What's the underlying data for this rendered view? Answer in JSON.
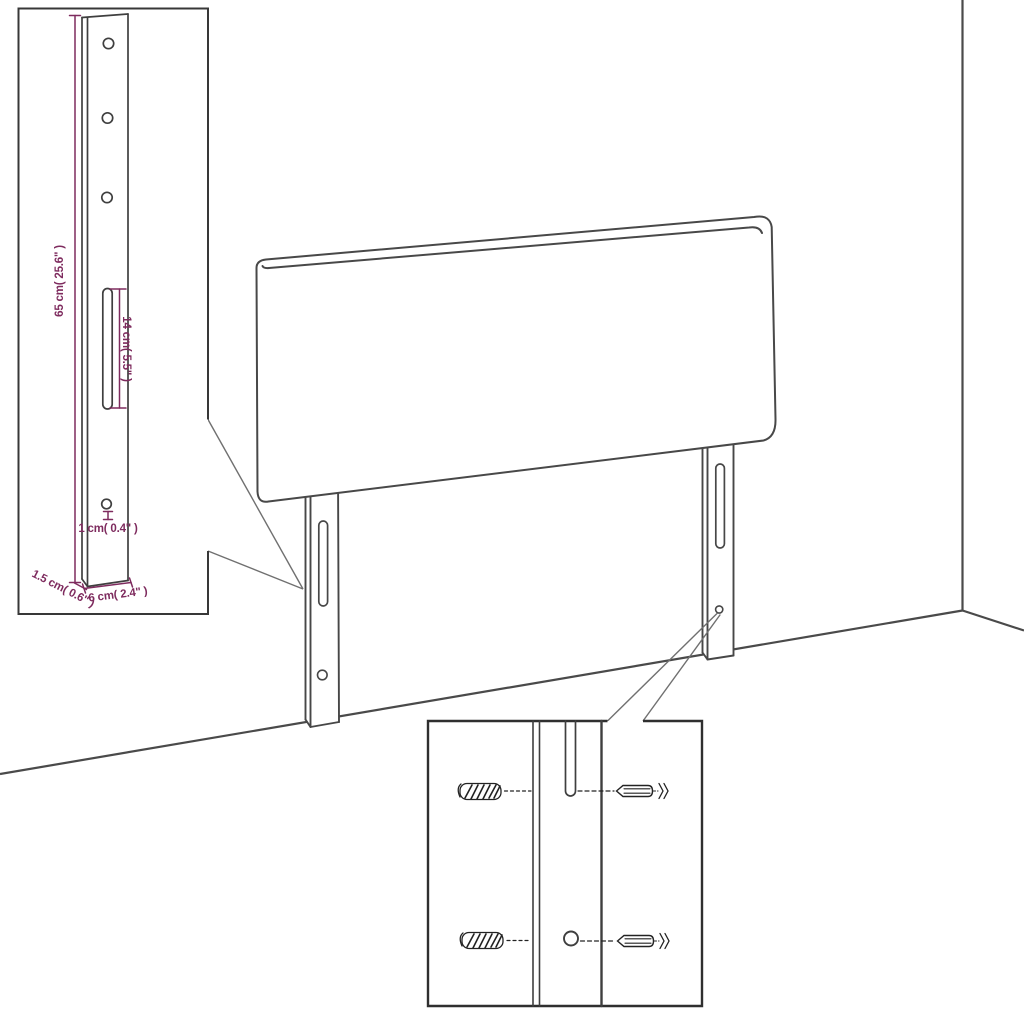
{
  "colors": {
    "background": "#ffffff",
    "line": "#474747",
    "inset_border": "#383838",
    "callout": "#707070",
    "dimension": "#7e2b5e"
  },
  "labels": {
    "leg_height": "65 cm( 25.6\" )",
    "slot_length": "14 cm( 5.5\" )",
    "hole_diameter": "1 cm( 0.4\" )",
    "leg_thickness": "1.5 cm( 0.6\" )",
    "leg_width": "6 cm( 2.4\" )"
  }
}
